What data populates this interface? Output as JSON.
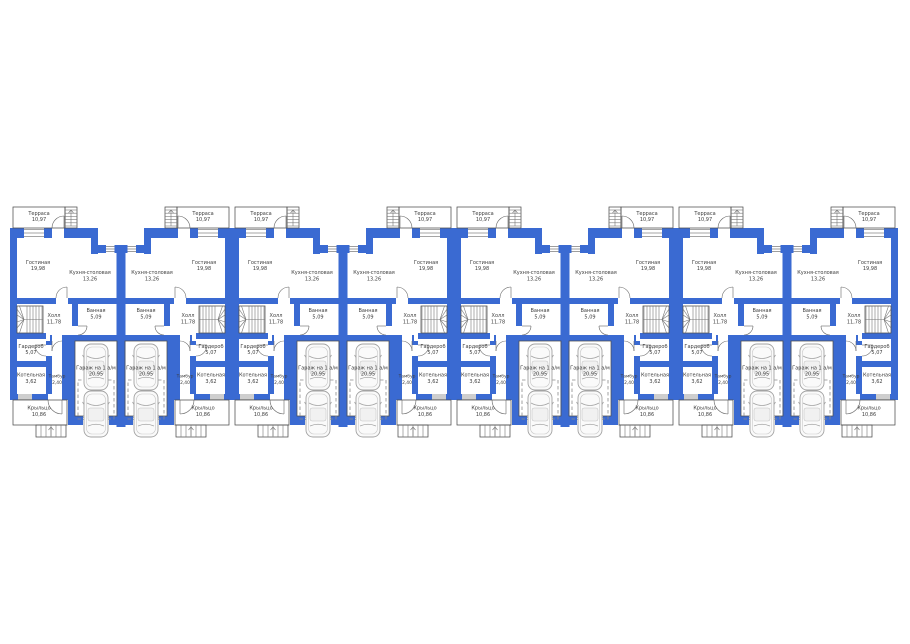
{
  "plan": {
    "unit_count": 8,
    "pair_count": 4,
    "rooms": {
      "terrace": {
        "label": "Терраса",
        "area": "10,97"
      },
      "living": {
        "label": "Гостиная",
        "area": "19,98"
      },
      "kitchen": {
        "label": "Кухня-столовая",
        "area": "13,26"
      },
      "bath": {
        "label": "Ванная",
        "area": "5,09"
      },
      "hall": {
        "label": "Холл",
        "area": "11,78"
      },
      "wardrobe": {
        "label": "Гардероб",
        "area": "5,07"
      },
      "boiler": {
        "label": "Котельная",
        "area": "3,62"
      },
      "tambour": {
        "label": "Тамбур",
        "area": "2,40"
      },
      "garage": {
        "label": "Гараж на 1 а/м",
        "area": "20,95"
      },
      "porch": {
        "label": "Крыльцо",
        "area": "10,86"
      }
    },
    "colors": {
      "wall": "#3a6ad2",
      "line": "#4d4d4d",
      "text": "#3d3d3d",
      "car": "#a3a3a3",
      "dash": "#8a8a8a",
      "background": "#ffffff"
    }
  }
}
